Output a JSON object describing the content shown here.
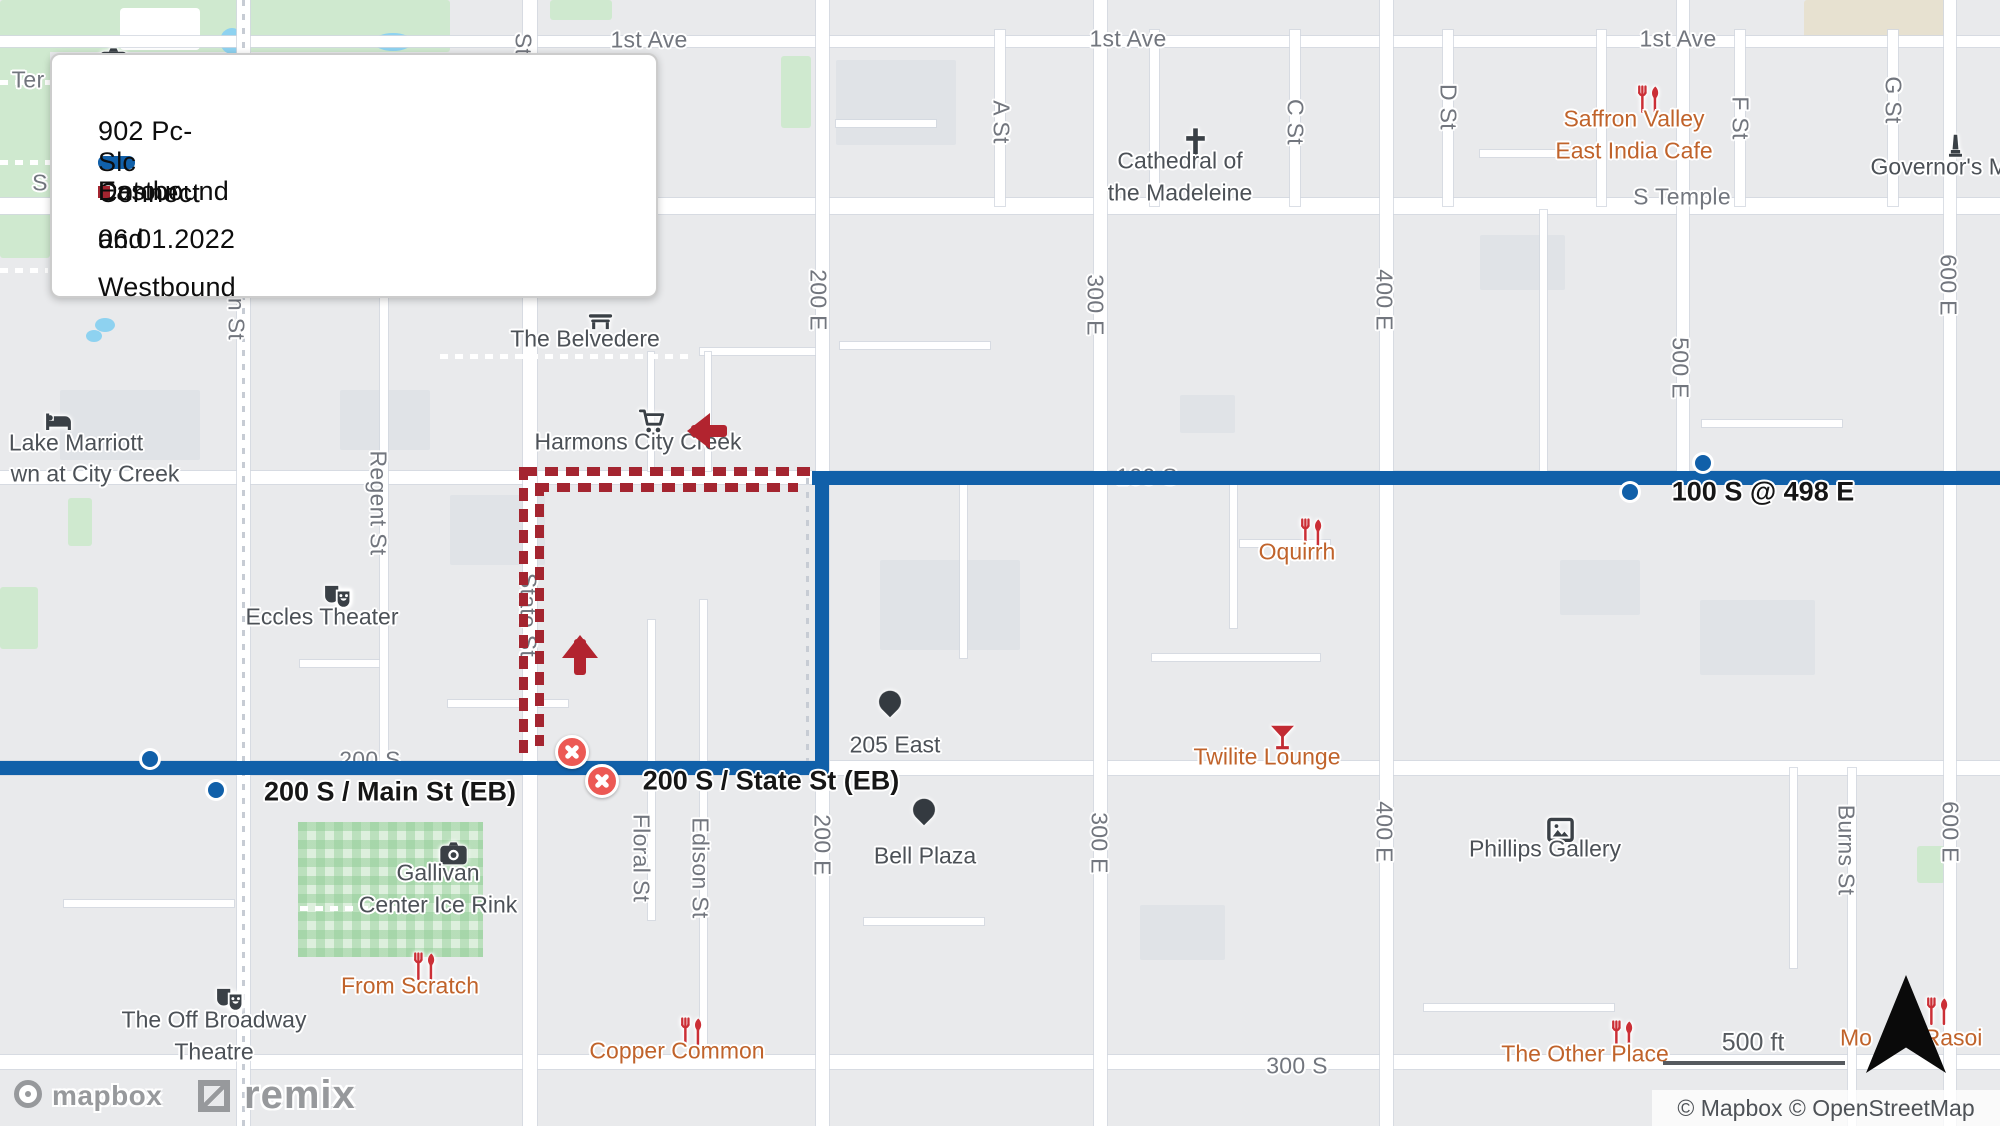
{
  "legend": {
    "route_label": "902 Pc-Slc Connect",
    "detour_line1": "Eastbound and Westbound",
    "detour_line2": "Detour 06.01.2022",
    "route_color": "#1160a9",
    "detour_color": "#a42530"
  },
  "street_labels": [
    {
      "t": "1st Ave",
      "x": 649,
      "y": 40
    },
    {
      "t": "1st Ave",
      "x": 1128,
      "y": 39
    },
    {
      "t": "1st Ave",
      "x": 1678,
      "y": 39
    },
    {
      "t": "S Temple",
      "x": 1682,
      "y": 197
    },
    {
      "t": "Ter",
      "x": 28,
      "y": 80
    },
    {
      "t": "S",
      "x": 40,
      "y": 183
    },
    {
      "t": "A St",
      "x": 1001,
      "y": 122,
      "r": 1
    },
    {
      "t": "C St",
      "x": 1295,
      "y": 122,
      "r": 1
    },
    {
      "t": "D St",
      "x": 1448,
      "y": 107,
      "r": 1
    },
    {
      "t": "F St",
      "x": 1740,
      "y": 118,
      "r": 1
    },
    {
      "t": "G St",
      "x": 1893,
      "y": 100,
      "r": 1
    },
    {
      "t": "State St",
      "x": 523,
      "y": 75,
      "r": 1
    },
    {
      "t": "Main St",
      "x": 236,
      "y": 300,
      "r": 1
    },
    {
      "t": "200 E",
      "x": 818,
      "y": 300,
      "r": 1
    },
    {
      "t": "300 E",
      "x": 1095,
      "y": 305,
      "r": 1
    },
    {
      "t": "400 E",
      "x": 1384,
      "y": 300,
      "r": 1
    },
    {
      "t": "500 E",
      "x": 1680,
      "y": 368,
      "r": 1
    },
    {
      "t": "600 E",
      "x": 1948,
      "y": 285,
      "r": 1
    },
    {
      "t": "200 E",
      "x": 822,
      "y": 845,
      "r": 1
    },
    {
      "t": "300 E",
      "x": 1099,
      "y": 843,
      "r": 1
    },
    {
      "t": "400 E",
      "x": 1384,
      "y": 832,
      "r": 1
    },
    {
      "t": "600 E",
      "x": 1950,
      "y": 832,
      "r": 1
    },
    {
      "t": "Burns St",
      "x": 1846,
      "y": 850,
      "r": 1
    },
    {
      "t": "Regent St",
      "x": 378,
      "y": 503,
      "r": 1
    },
    {
      "t": "Floral St",
      "x": 641,
      "y": 858,
      "r": 1
    },
    {
      "t": "Edison St",
      "x": 700,
      "y": 868,
      "r": 1
    },
    {
      "t": "State St",
      "x": 528,
      "y": 615,
      "r": 1,
      "u": 1
    },
    {
      "t": "100 S",
      "x": 1147,
      "y": 477,
      "u": 1
    },
    {
      "t": "200 S",
      "x": 370,
      "y": 760,
      "u": 1
    },
    {
      "t": "300 S",
      "x": 1297,
      "y": 1066
    }
  ],
  "pois": [
    {
      "icon": "camera",
      "x": 98,
      "y": 44,
      "color": "dark",
      "lines": []
    },
    {
      "icon": "cross",
      "x": 1180,
      "y": 126,
      "color": "dark",
      "lines": [
        "Cathedral of",
        "the Madeleine"
      ]
    },
    {
      "icon": "restaurant",
      "x": 1634,
      "y": 84,
      "color": "orange",
      "lines": [
        "Saffron Valley",
        "East India Cafe"
      ]
    },
    {
      "icon": "monument",
      "x": 1940,
      "y": 132,
      "color": "dark",
      "lines": [
        "Governor's Man"
      ],
      "lx": 1952
    },
    {
      "icon": "bench",
      "x": 585,
      "y": 304,
      "color": "dark",
      "lines": [
        "The Belvedere"
      ]
    },
    {
      "icon": "bed",
      "x": 43,
      "y": 406,
      "color": "dark",
      "lines": [
        "Lake Marriott",
        "wn at City Creek"
      ],
      "line_pos": [
        [
          76,
          443
        ],
        [
          95,
          474
        ]
      ]
    },
    {
      "icon": "cart",
      "x": 638,
      "y": 407,
      "color": "dark",
      "lines": [
        "Harmons City Creek"
      ]
    },
    {
      "icon": "masks",
      "x": 322,
      "y": 582,
      "color": "dark",
      "lines": [
        "Eccles Theater"
      ]
    },
    {
      "icon": "restaurant",
      "x": 1297,
      "y": 517,
      "color": "orange",
      "lines": [
        "Oquirrh"
      ]
    },
    {
      "icon": "martini",
      "x": 1267,
      "y": 722,
      "color": "orange",
      "lines": [
        "Twilite Lounge"
      ]
    },
    {
      "icon": "frame",
      "x": 1545,
      "y": 814,
      "color": "dark",
      "lines": [
        "Phillips Gallery"
      ]
    },
    {
      "icon": "camera",
      "x": 438,
      "y": 838,
      "color": "dark",
      "lines": [
        "Gallivan",
        "Center Ice Rink"
      ]
    },
    {
      "icon": "restaurant",
      "x": 410,
      "y": 951,
      "color": "orange",
      "lines": [
        "From Scratch"
      ]
    },
    {
      "icon": "masks",
      "x": 214,
      "y": 985,
      "color": "dark",
      "lines": [
        "The Off Broadway",
        "Theatre"
      ]
    },
    {
      "icon": "restaurant",
      "x": 677,
      "y": 1016,
      "color": "orange",
      "lines": [
        "Copper Common"
      ]
    },
    {
      "icon": "restaurant",
      "x": 1608,
      "y": 1019,
      "color": "orange",
      "lines": [
        "The Other Place"
      ],
      "lx": 1585
    },
    {
      "icon": "restaurant",
      "x": 1923,
      "y": 996,
      "color": "orange",
      "lines": []
    },
    {
      "icon": null,
      "x": 1856,
      "y": 1038,
      "color": "orange",
      "lines": [
        "Mo"
      ],
      "label_only": 1
    },
    {
      "icon": null,
      "x": 1953,
      "y": 1038,
      "color": "orange",
      "lines": [
        "Rasoi"
      ],
      "label_only": 1
    }
  ],
  "pins": [
    {
      "label": "205 East",
      "x": 890,
      "y": 705,
      "lx": 895,
      "ly": 745
    },
    {
      "label": "Bell Plaza",
      "x": 924,
      "y": 813,
      "lx": 925,
      "ly": 856
    }
  ],
  "stops": [
    {
      "x": 1703,
      "y": 463
    },
    {
      "x": 1630,
      "y": 492
    },
    {
      "x": 150,
      "y": 759
    },
    {
      "x": 216,
      "y": 790
    }
  ],
  "stop_labels": [
    {
      "t": "100 S @ 498 E",
      "x": 1763,
      "y": 492
    },
    {
      "t": "200 S / Main St (EB)",
      "x": 390,
      "y": 792
    },
    {
      "t": "200 S / State St (EB)",
      "x": 771,
      "y": 781
    }
  ],
  "closures": [
    {
      "x": 572,
      "y": 752
    },
    {
      "x": 602,
      "y": 781
    }
  ],
  "arrows": [
    {
      "dir": "left",
      "x": 698,
      "y": 431
    },
    {
      "dir": "up",
      "x": 580,
      "y": 646
    }
  ],
  "scale_bar": {
    "label": "500 ft"
  },
  "attribution": "© Mapbox © OpenStreetMap",
  "logos": {
    "mapbox": "mapbox",
    "remix": "remix"
  }
}
